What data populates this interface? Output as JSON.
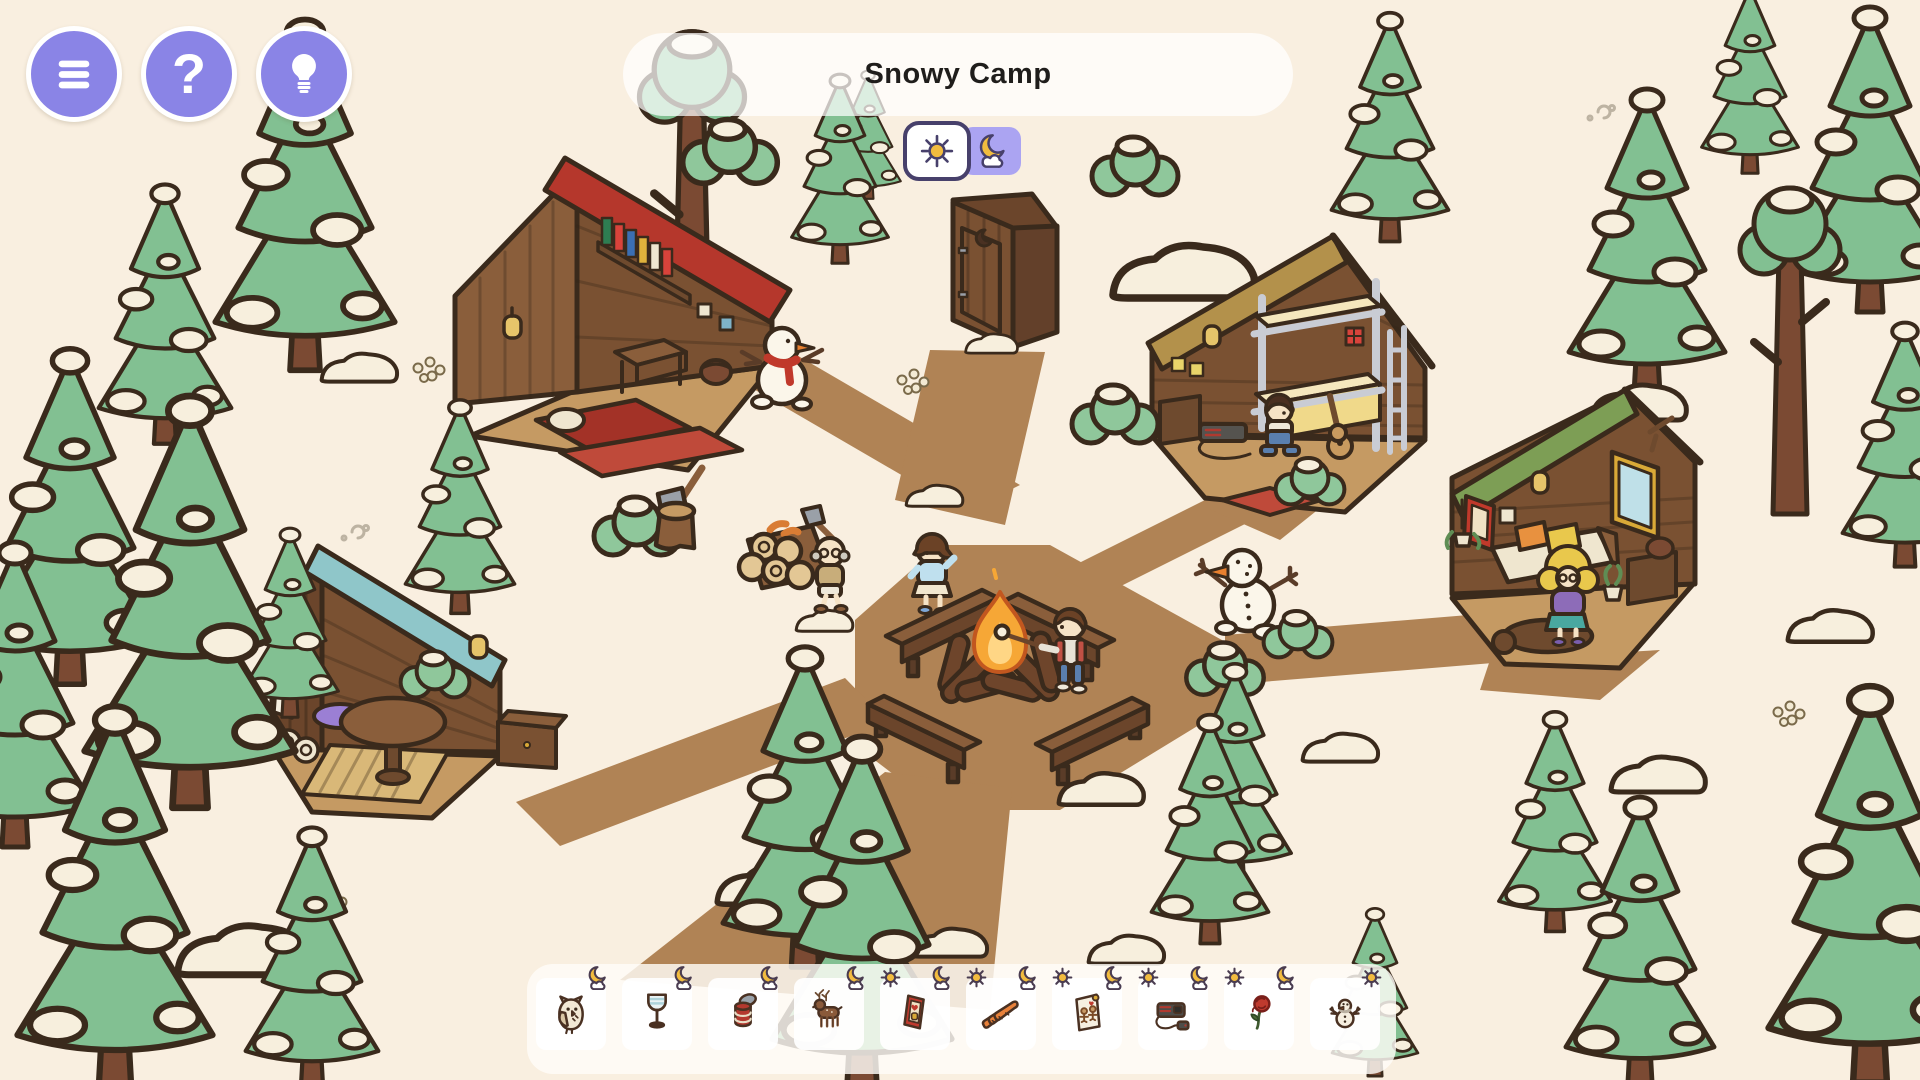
{
  "hud": {
    "title": "Snowy Camp",
    "menu_buttons": [
      {
        "id": "menu",
        "icon": "menu-icon"
      },
      {
        "id": "help",
        "icon": "question-icon",
        "glyph": "?"
      },
      {
        "id": "hint",
        "icon": "lightbulb-icon"
      }
    ],
    "time_toggle": {
      "selected": "day",
      "options": [
        {
          "id": "day",
          "icon": "sun-icon"
        },
        {
          "id": "night",
          "icon": "moon-cloud-icon"
        }
      ]
    }
  },
  "find_bar": {
    "items": [
      {
        "id": "owl",
        "label": "Owl",
        "icon": "owl-icon",
        "day": false,
        "night": true
      },
      {
        "id": "wine-glass",
        "label": "Wine glass",
        "icon": "wine-glass-icon",
        "day": false,
        "night": true
      },
      {
        "id": "tin-can",
        "label": "Tin can",
        "icon": "tin-can-icon",
        "day": false,
        "night": true
      },
      {
        "id": "deer",
        "label": "Deer",
        "icon": "deer-icon",
        "day": false,
        "night": true
      },
      {
        "id": "playing-card",
        "label": "Playing card",
        "icon": "playing-card-icon",
        "day": true,
        "night": true
      },
      {
        "id": "carrots",
        "label": "Carrots",
        "icon": "carrots-icon",
        "day": true,
        "night": true
      },
      {
        "id": "gingerbread-card",
        "label": "Gingerbread card",
        "icon": "gingerbread-card-icon",
        "day": true,
        "night": true
      },
      {
        "id": "game-console",
        "label": "Game console",
        "icon": "game-console-icon",
        "day": true,
        "night": true
      },
      {
        "id": "rose",
        "label": "Rose",
        "icon": "rose-icon",
        "day": true,
        "night": true
      },
      {
        "id": "snowman",
        "label": "Snowman",
        "icon": "snowman-icon",
        "day": true,
        "night": false
      }
    ]
  },
  "scene": {
    "name": "Snowy Camp",
    "objects": [
      {
        "id": "cabin-red",
        "label": "Red-roof bedroom cabin"
      },
      {
        "id": "cabin-bunk",
        "label": "Bunk-bed cabin"
      },
      {
        "id": "cabin-green",
        "label": "Green-roof bedroom cabin"
      },
      {
        "id": "cabin-teal",
        "label": "Teal-roof lounge cabin"
      },
      {
        "id": "outhouse",
        "label": "Wooden outhouse"
      },
      {
        "id": "campfire",
        "label": "Campfire with four benches"
      },
      {
        "id": "snowman-scarf",
        "label": "Snowman with red scarf"
      },
      {
        "id": "snowman-sticks",
        "label": "Snowman with stick arms"
      },
      {
        "id": "log-pile",
        "label": "Log pile with carrots"
      },
      {
        "id": "axe-stump",
        "label": "Axe in stump"
      },
      {
        "id": "camper-boy-fire",
        "label": "Boy roasting marshmallow"
      },
      {
        "id": "camper-girl-walking",
        "label": "Girl walking"
      },
      {
        "id": "camper-old-man",
        "label": "Old man carrying axe"
      },
      {
        "id": "camper-boy-bunk",
        "label": "Boy in bunk cabin"
      },
      {
        "id": "camper-girl-blonde",
        "label": "Blonde girl in cabin"
      }
    ]
  },
  "colors": {
    "accent_purple": "#8a84e6",
    "toggle_night_bg": "#aba4f2",
    "toggle_border": "#47406b",
    "ground": "#f9efe0",
    "path_brown": "#b08355",
    "tree_green": "#82c092",
    "snow": "#f7efdd",
    "outline": "#3a2a1c",
    "roof_red": "#b5372c",
    "roof_tan": "#b3914b",
    "roof_green": "#7d9e55",
    "roof_teal": "#8fc6c9",
    "wood": "#8a5e3b",
    "flame": "#f6a736"
  }
}
